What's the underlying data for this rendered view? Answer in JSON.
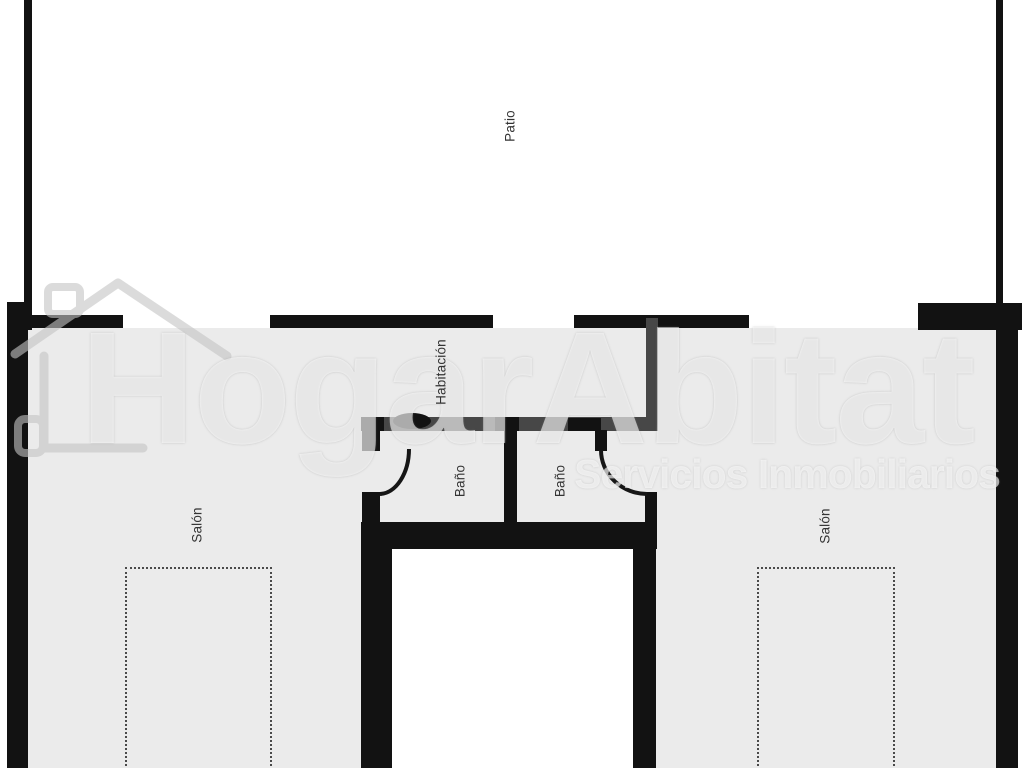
{
  "plan": {
    "rooms": {
      "patio": "Patio",
      "habitacion": "Habitación",
      "bano": "Baño",
      "salon": "Salón"
    }
  },
  "watermark": {
    "title": "HogarAbitat",
    "subtitle": "Servicios Inmobiliarios"
  },
  "colors": {
    "wall": "#121212",
    "partition": "#474747",
    "floor": "#ebebeb",
    "background": "#ffffff",
    "label": "#333333",
    "dotted": "#4a4a4a"
  }
}
